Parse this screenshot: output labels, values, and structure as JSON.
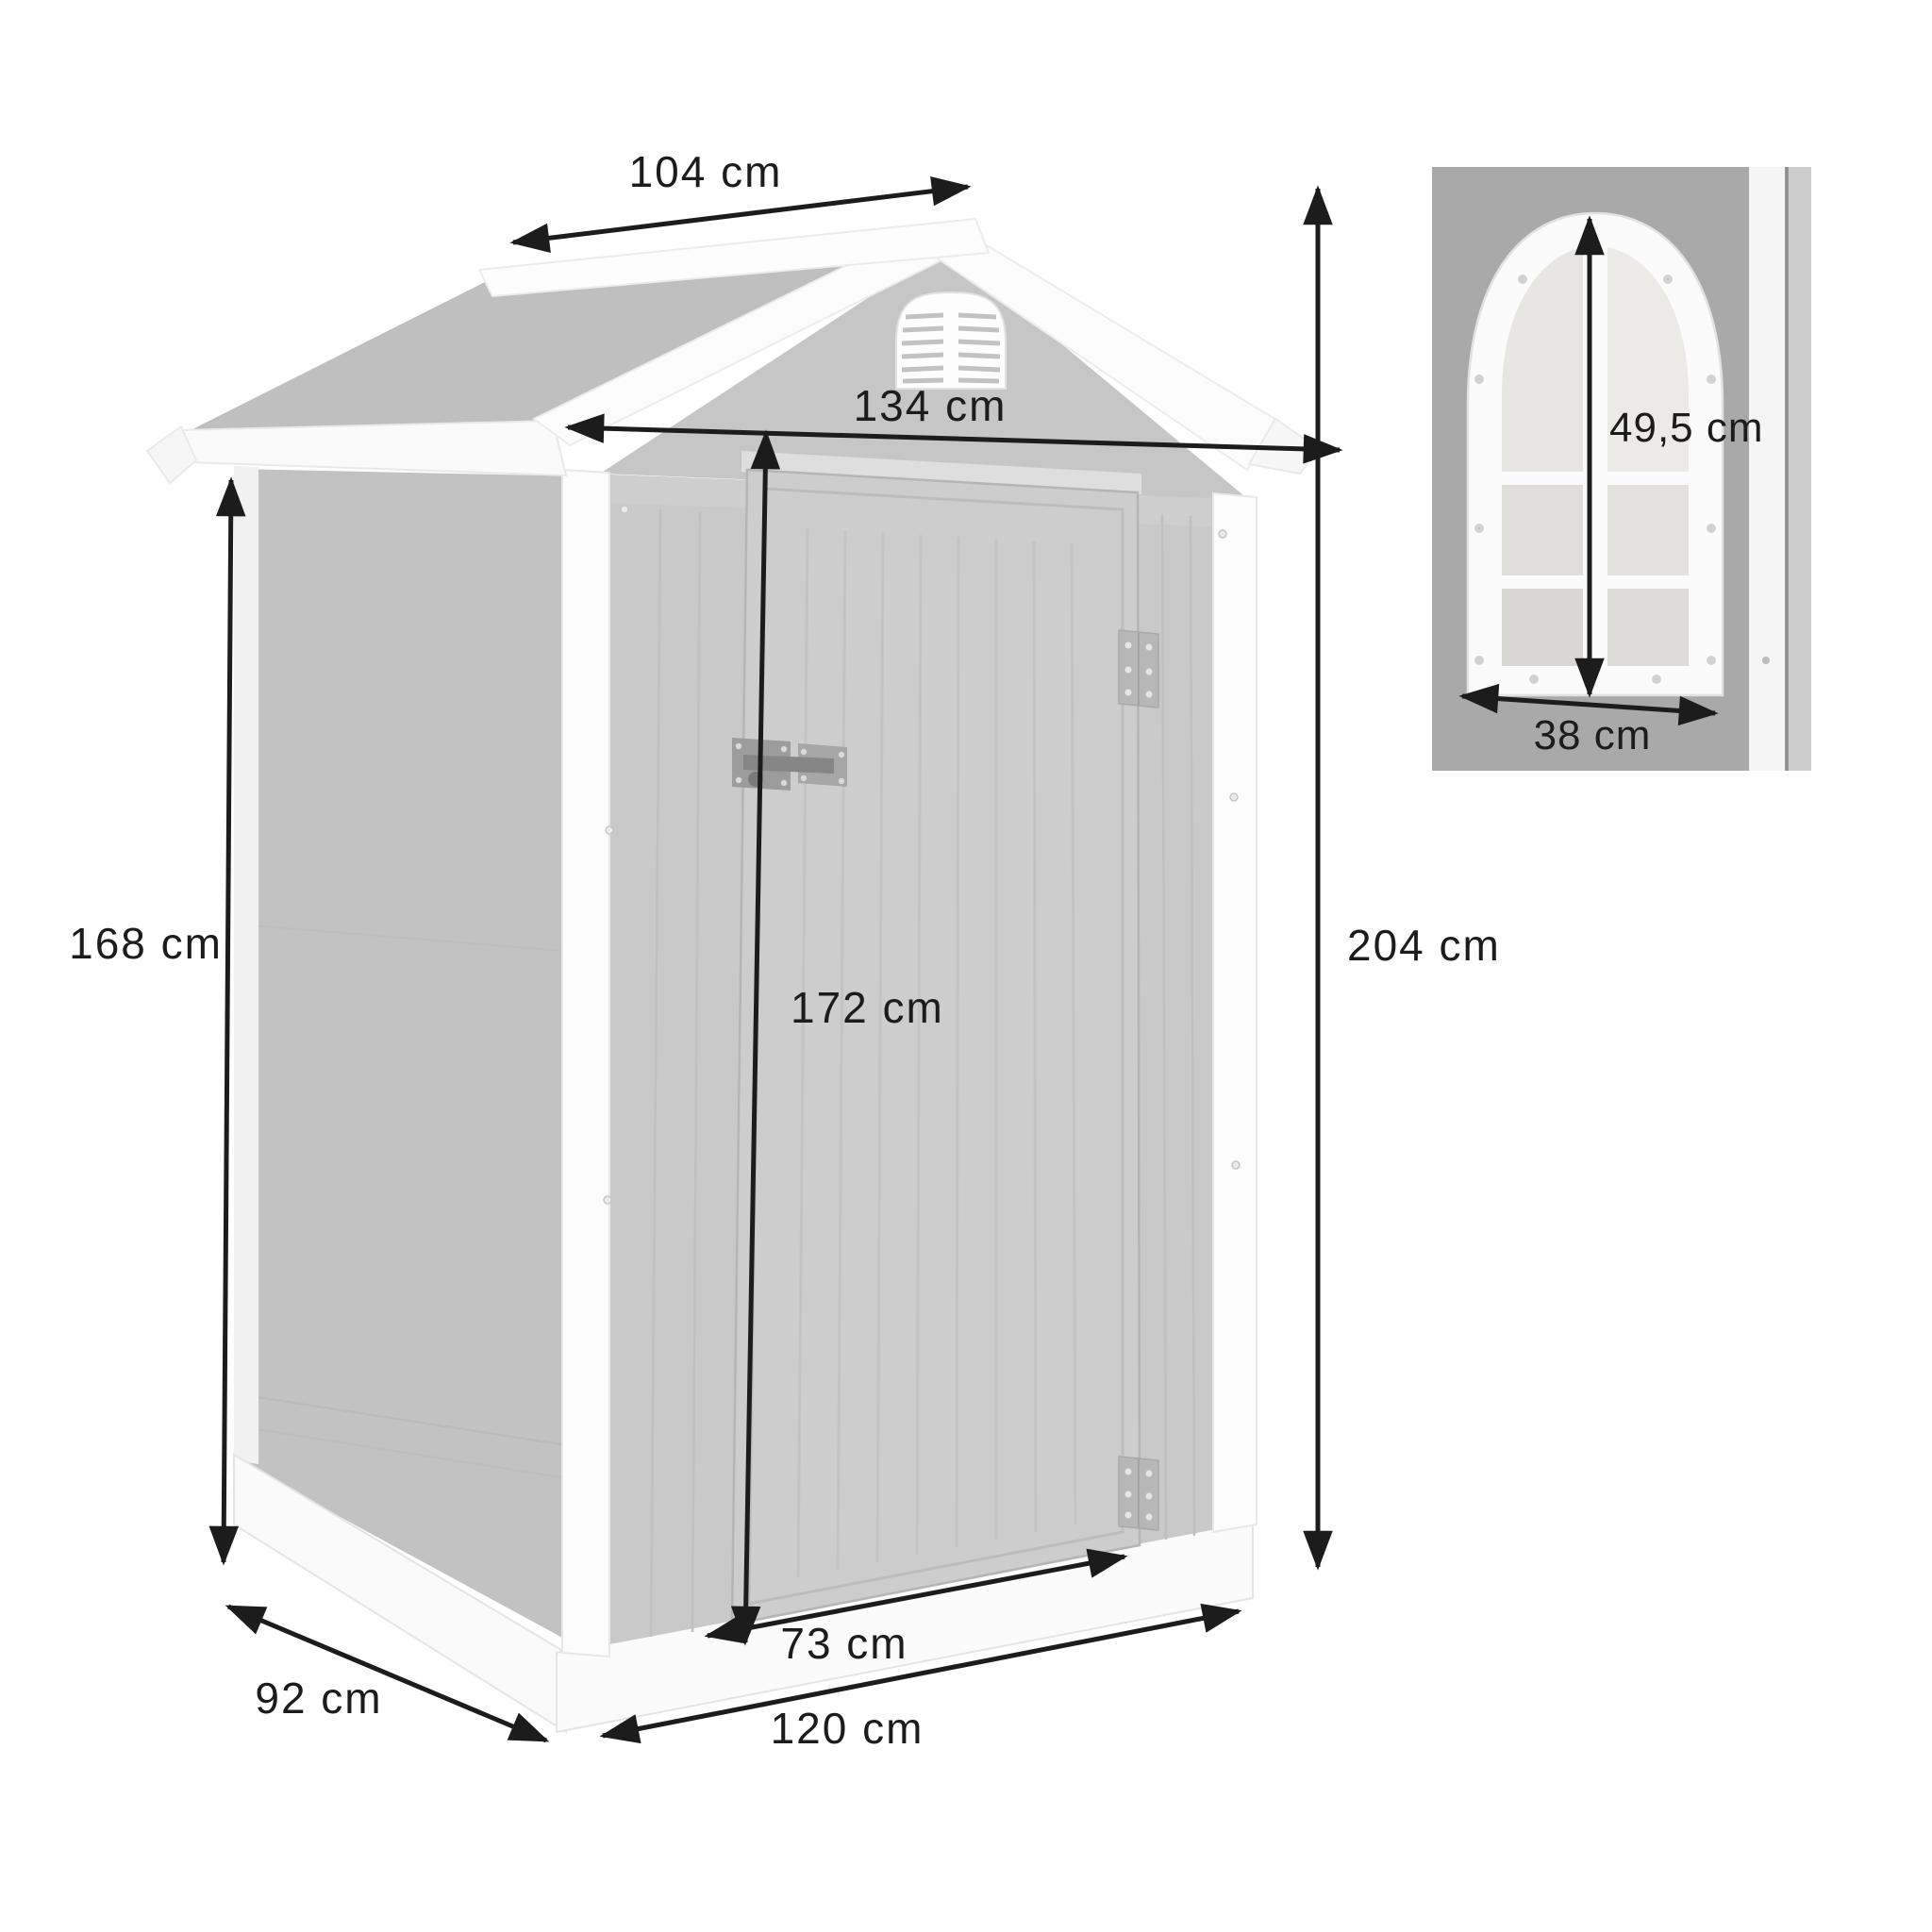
{
  "diagram": {
    "type": "product-dimension-diagram",
    "subject": "plastic garden storage shed with window detail inset",
    "colors": {
      "background": "#ffffff",
      "wall_gray": "#c9c9c9",
      "side_wall_gray": "#c2c2c2",
      "roof_gray": "#bfbfbf",
      "trim_white": "#fbfbfb",
      "dimension_line": "#1c1c1c",
      "inset_background": "#a9a9a9"
    },
    "dimensions": {
      "roof_depth": {
        "label": "104 cm"
      },
      "roof_width": {
        "label": "134 cm"
      },
      "wall_height": {
        "label": "168 cm"
      },
      "total_height": {
        "label": "204 cm"
      },
      "door_height": {
        "label": "172 cm"
      },
      "door_width": {
        "label": "73 cm"
      },
      "base_width": {
        "label": "120 cm"
      },
      "base_depth": {
        "label": "92 cm"
      }
    },
    "inset": {
      "window_height": {
        "label": "49,5 cm"
      },
      "window_width": {
        "label": "38 cm"
      }
    }
  }
}
